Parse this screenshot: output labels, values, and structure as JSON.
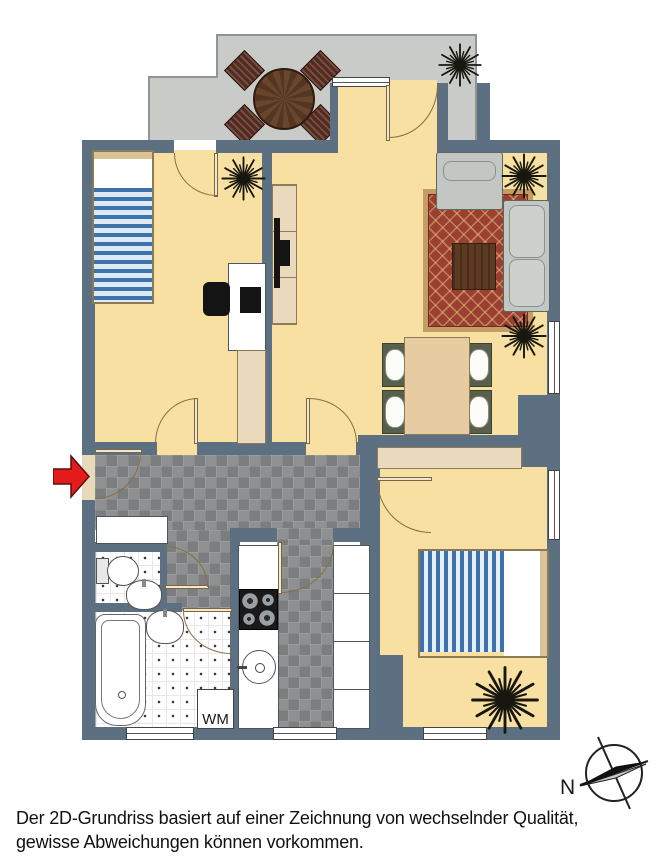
{
  "labels": {
    "washing_machine": "WM",
    "compass_north": "N"
  },
  "disclaimer": {
    "line1": "Der 2D-Grundriss basiert auf einer Zeichnung von wechselnder Qualität,",
    "line2": "gewisse Abweichungen können vorkommen."
  },
  "colors": {
    "wall": "#5d7081",
    "room_floor": "#f8dfa2",
    "balcony_floor": "#c9cbc9",
    "hall_tile": "#8e9092",
    "carpet": "#9c3f33",
    "bed_stripe": "#3f72aa",
    "entrance_arrow": "#e31b1b"
  }
}
